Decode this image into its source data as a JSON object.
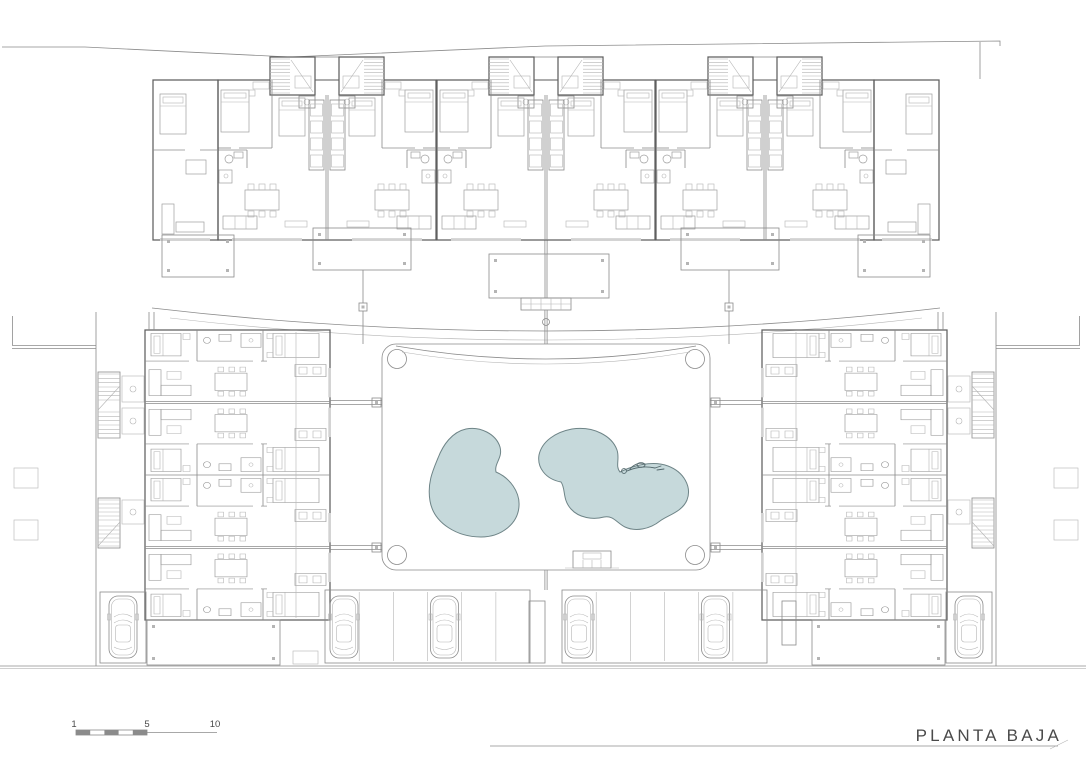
{
  "title": {
    "label": "PLANTA BAJA"
  },
  "scale_bar": {
    "labels": [
      "1",
      "5",
      "10"
    ]
  },
  "colors": {
    "background": "#ffffff",
    "line": "#8b8b8b",
    "wall": "#5f5f5f",
    "light_line": "#b5b5b5",
    "furniture": "#9e9e9e",
    "window": "#d2d2d2",
    "pool_fill": "#c6d9db",
    "pool_edge": "#6e8487",
    "text": "#4a4a4a"
  },
  "plan": {
    "pools": 2,
    "cars": 6,
    "top_row_units": 6,
    "left_wing_units": 4,
    "right_wing_units": 4
  },
  "icons": {
    "swimmer": "person-swimming",
    "car": "car-top-view",
    "stairs": "staircase-hatch"
  }
}
